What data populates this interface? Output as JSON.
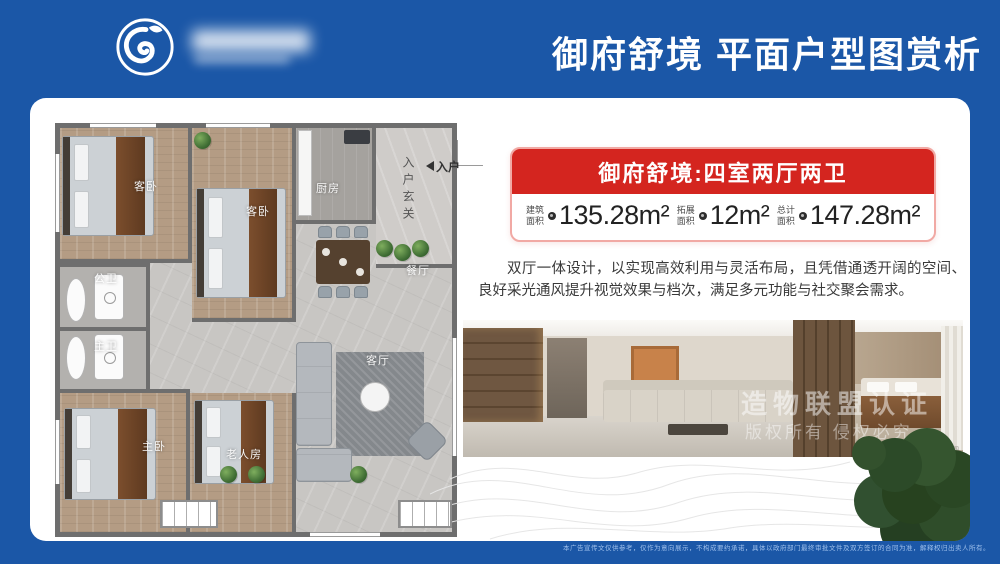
{
  "header": {
    "title": "御府舒境 平面户型图赏析"
  },
  "info_card": {
    "banner": "御府舒境:四室两厅两卫",
    "stats": [
      {
        "label_line1": "建筑",
        "label_line2": "面积",
        "value": "135.28m²"
      },
      {
        "label_line1": "拓展",
        "label_line2": "面积",
        "value": "12m²"
      },
      {
        "label_line1": "总计",
        "label_line2": "面积",
        "value": "147.28m²"
      }
    ]
  },
  "description": "双厅一体设计，以实现高效利用与灵活布局，且凭借通透开阔的空间、良好采光通风提升视觉效果与档次，满足多元功能与社交聚会需求。",
  "floorplan": {
    "labels": {
      "guest_bedroom_1": "客卧",
      "guest_bedroom_2": "客卧",
      "kitchen": "厨房",
      "entry_hall": "入户玄关",
      "dining": "餐厅",
      "public_bathroom": "公卫",
      "master_bathroom": "主卫",
      "living": "客厅",
      "master_bedroom": "主卧",
      "elder_room": "老人房"
    },
    "entry_label": "入户"
  },
  "photo": {
    "watermark_line1": "造物联盟认证",
    "watermark_line2": "版权所有 侵权必究",
    "caption": "效果图"
  },
  "footer": {
    "disclaimer": "本广告宣传文仅供参考，仅作为意向展示，不构成要约承诺，具体以政府部门最终审批文件及双方签订的合同为准，解释权归出卖人所有。"
  },
  "colors": {
    "brand_blue": "#1b57a7",
    "banner_red": "#d4251f",
    "border_pink": "#f1a9a4"
  }
}
